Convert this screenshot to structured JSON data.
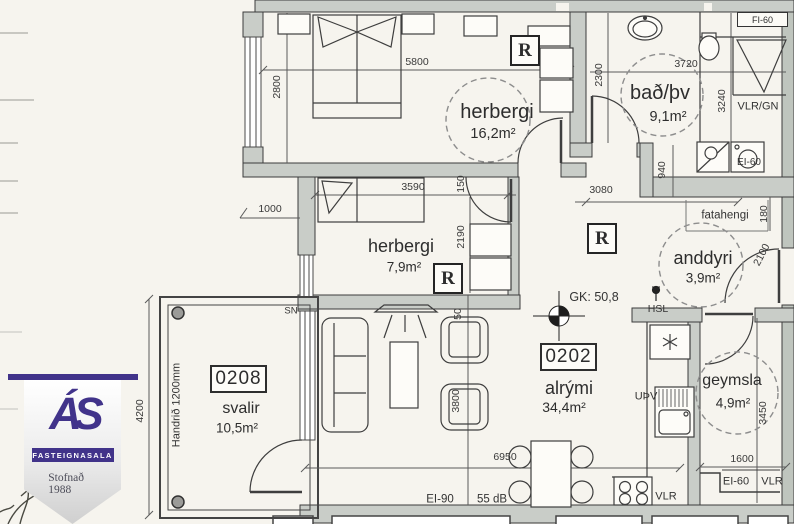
{
  "rooms": {
    "bedroom1": {
      "name": "herbergi",
      "area": "16,2m²"
    },
    "bath": {
      "name": "bað/þv",
      "area": "9,1m²"
    },
    "bedroom2": {
      "name": "herbergi",
      "area": "7,9m²"
    },
    "entry": {
      "name": "anddyri",
      "area": "3,9m²"
    },
    "living": {
      "name": "alrými",
      "area": "34,4m²",
      "unit": "0202"
    },
    "storage": {
      "name": "geymsla",
      "area": "4,9m²"
    },
    "balcony": {
      "name": "svalir",
      "area": "10,5m²",
      "unit": "0208"
    }
  },
  "dims": {
    "d2800": "2800",
    "d5800": "5800",
    "d2300": "2300",
    "d3720": "3720",
    "d3240": "3240",
    "d940": "940",
    "d1000": "1000",
    "d3590": "3590",
    "d150": "150",
    "d2190": "2190",
    "d3080": "3080",
    "d180": "180",
    "d2100": "2100",
    "d50": "50",
    "d3800": "3800",
    "d6950": "6950",
    "d4200": "4200",
    "d3450": "3450",
    "d1600": "1600"
  },
  "annotations": {
    "r": "R",
    "gk": "GK: 50,8",
    "hsl": "HSL",
    "upv": "UÞV",
    "vlr": "VLR",
    "vlr_gn": "VLR/GN",
    "ei60": "EI-60",
    "fi60": "FI-60",
    "ei90": "EI-90",
    "db": "55 dB",
    "sn": "SN",
    "fatahengi": "fatahengi",
    "handrid": "Handrið 1200mm"
  },
  "logo": {
    "initials": "ÁS",
    "subtitle": "FASTEIGNASALA",
    "tagline": "Stofnað 1988",
    "purple": "#41338a"
  },
  "colors": {
    "paper": "#f6f4ee",
    "wall": "#c9cdc8",
    "line": "#3c3c3c"
  }
}
